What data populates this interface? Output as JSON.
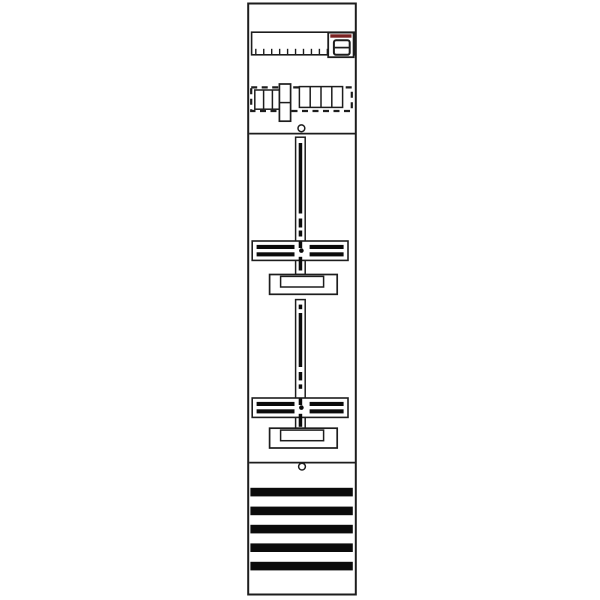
{
  "figure": {
    "type": "technical-line-diagram",
    "subject": "single-field meter panel (distribution board) front view with two meter mounting crosses and cover strips",
    "background": "#ffffff"
  },
  "colors": {
    "outline": "#1d1d1d",
    "ink": "#0b0b0b",
    "paper": "#ffffff",
    "accent_red": "#7a2121"
  },
  "ruler": {
    "tick_count": 10
  },
  "device_icon": {
    "name": "din-device-icon",
    "cells": 2
  },
  "terminal_row": {
    "left_block_cells": 3,
    "right_block_cells": 4,
    "tall_block_cells": 2
  },
  "screws": {
    "count": 2
  },
  "meter_fields": [
    {
      "name": "meter-field-1",
      "slot_segments_y": [
        [
          143.0,
          213.5
        ],
        [
          218.5,
          227.5
        ],
        [
          230.5,
          236.5
        ],
        [
          241.5,
          248.0
        ],
        [
          256.8,
          270.5
        ]
      ],
      "center_dot_y": 250.6
    },
    {
      "name": "meter-field-2",
      "slot_segments_y": [
        [
          304.6,
          309.2
        ],
        [
          313.0,
          367.0
        ],
        [
          372.0,
          380.4
        ],
        [
          384.4,
          388.8
        ],
        [
          398.5,
          405.0
        ],
        [
          413.8,
          426.8
        ]
      ],
      "center_dot_y": 407.6
    }
  ],
  "cover_strips": {
    "count": 5,
    "ys": [
      487.8,
      506.6,
      524.8,
      543.4,
      561.8
    ]
  }
}
